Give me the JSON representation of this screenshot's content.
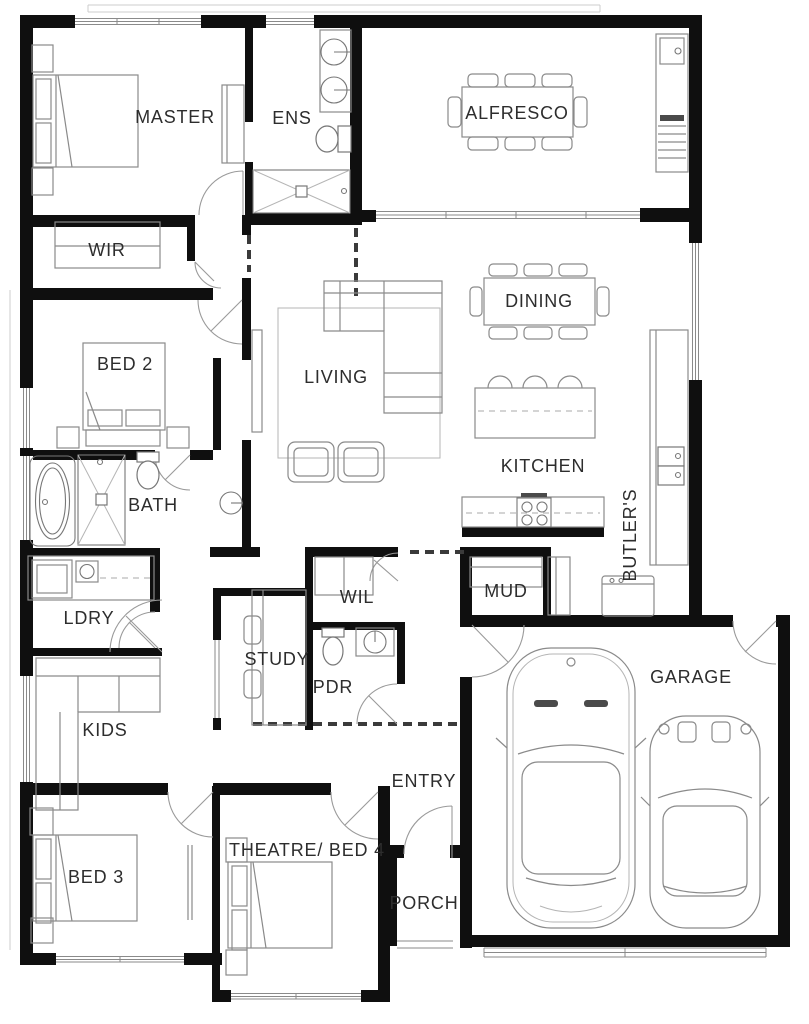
{
  "plan_type": "residential-floor-plan",
  "colors": {
    "wall": "#0f0f0f",
    "furniture_line": "#8a8a8a",
    "label": "#2d2d2d",
    "background": "#ffffff"
  },
  "rooms": [
    {
      "id": "master",
      "label": "MASTER"
    },
    {
      "id": "ens",
      "label": "ENS"
    },
    {
      "id": "alfresco",
      "label": "ALFRESCO"
    },
    {
      "id": "wir",
      "label": "WIR"
    },
    {
      "id": "bed2",
      "label": "BED 2"
    },
    {
      "id": "living",
      "label": "LIVING"
    },
    {
      "id": "dining",
      "label": "DINING"
    },
    {
      "id": "kitchen",
      "label": "KITCHEN"
    },
    {
      "id": "bath",
      "label": "BATH"
    },
    {
      "id": "butlers",
      "label": "BUTLER'S"
    },
    {
      "id": "ldry",
      "label": "LDRY"
    },
    {
      "id": "wil",
      "label": "WIL"
    },
    {
      "id": "mud",
      "label": "MUD"
    },
    {
      "id": "study",
      "label": "STUDY"
    },
    {
      "id": "pdr",
      "label": "PDR"
    },
    {
      "id": "kids",
      "label": "KIDS"
    },
    {
      "id": "entry",
      "label": "ENTRY"
    },
    {
      "id": "bed3",
      "label": "BED 3"
    },
    {
      "id": "theatre",
      "label": "THEATRE/ BED 4"
    },
    {
      "id": "porch",
      "label": "PORCH"
    },
    {
      "id": "garage",
      "label": "GARAGE"
    }
  ]
}
